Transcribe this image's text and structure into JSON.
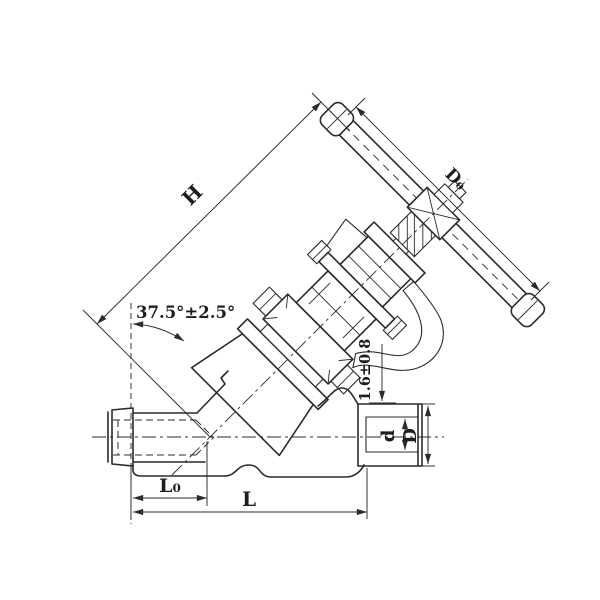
{
  "drawing": {
    "kind": "valve-engineering-drawing",
    "description": "Sectioned outline drawing of an angled (Y-pattern) globe valve with edge-on handwheel, socket-weld ends and dimension callouts",
    "background_color": "#ffffff",
    "line_color": "#2b2b2b",
    "labels": {
      "height": "H",
      "handwheel_diameter": "D₀",
      "stem_angle": "37.5°±2.5°",
      "socket_gap": "1.6±0.8",
      "bore_diameter": "d",
      "end_outer_diameter": "D",
      "center_to_face": "L₀",
      "face_to_face": "L"
    }
  }
}
